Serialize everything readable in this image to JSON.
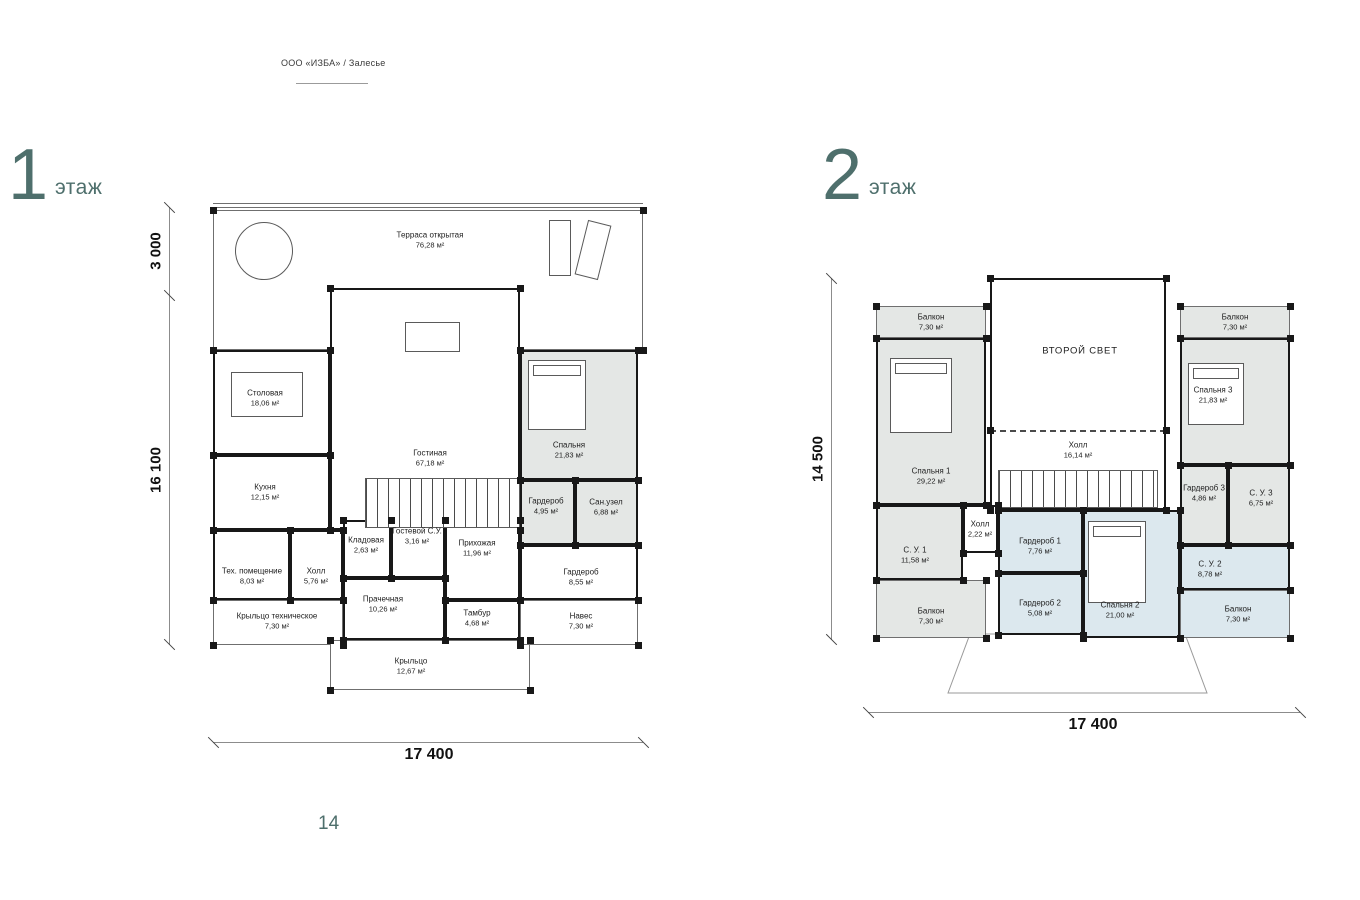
{
  "header": {
    "company": "ООО «ИЗБА» / Залесье"
  },
  "footer": {
    "page_number": "14"
  },
  "colors": {
    "accent": "#4e6f6c",
    "wall": "#181818",
    "room_gray": "#e4e7e5",
    "room_blue": "#dce8ee"
  },
  "floor1": {
    "number": "1",
    "word": "этаж",
    "dims": {
      "left_top": "3 000",
      "left_main": "16 100",
      "bottom": "17 400"
    },
    "rooms": [
      {
        "key": "terrasa",
        "name": "Терраса открытая",
        "area": "76,28 м²",
        "x": 0,
        "y": 10,
        "w": 430,
        "h": 140,
        "lx": 217,
        "ly": 40,
        "cls": "open"
      },
      {
        "key": "stolovaya",
        "name": "Столовая",
        "area": "18,06 м²",
        "x": 0,
        "y": 150,
        "w": 117,
        "h": 105,
        "lx": 52,
        "ly": 198,
        "cls": ""
      },
      {
        "key": "kuhnya",
        "name": "Кухня",
        "area": "12,15 м²",
        "x": 0,
        "y": 255,
        "w": 117,
        "h": 75,
        "lx": 52,
        "ly": 292,
        "cls": ""
      },
      {
        "key": "teh-pomeschenie",
        "name": "Тех. помещение",
        "area": "8,03 м²",
        "x": 0,
        "y": 330,
        "w": 77,
        "h": 70,
        "lx": 39,
        "ly": 376,
        "cls": ""
      },
      {
        "key": "holl",
        "name": "Холл",
        "area": "5,76 м²",
        "x": 77,
        "y": 330,
        "w": 53,
        "h": 70,
        "lx": 103,
        "ly": 376,
        "cls": ""
      },
      {
        "key": "kryltso-teh",
        "name": "Крыльцо техническое",
        "area": "7,30 м²",
        "x": 0,
        "y": 400,
        "w": 130,
        "h": 45,
        "lx": 64,
        "ly": 421,
        "cls": "open"
      },
      {
        "key": "gostinaya",
        "name": "Гостиная",
        "area": "67,18 м²",
        "x": 117,
        "y": 88,
        "w": 190,
        "h": 242,
        "lx": 217,
        "ly": 258,
        "cls": ""
      },
      {
        "key": "kladovaya",
        "name": "Кладовая",
        "area": "2,63 м²",
        "x": 130,
        "y": 320,
        "w": 48,
        "h": 58,
        "lx": 153,
        "ly": 345,
        "cls": ""
      },
      {
        "key": "gostevoy-su",
        "name": "Гостевой С.У.",
        "area": "3,16 м²",
        "x": 178,
        "y": 320,
        "w": 54,
        "h": 58,
        "lx": 204,
        "ly": 336,
        "cls": ""
      },
      {
        "key": "prihozhaya",
        "name": "Прихожая",
        "area": "11,96 м²",
        "x": 232,
        "y": 320,
        "w": 75,
        "h": 80,
        "lx": 264,
        "ly": 348,
        "cls": ""
      },
      {
        "key": "prachechnaya",
        "name": "Прачечная",
        "area": "10,26 м²",
        "x": 130,
        "y": 378,
        "w": 102,
        "h": 62,
        "lx": 170,
        "ly": 404,
        "cls": ""
      },
      {
        "key": "tambur",
        "name": "Тамбур",
        "area": "4,68 м²",
        "x": 232,
        "y": 400,
        "w": 75,
        "h": 40,
        "lx": 264,
        "ly": 418,
        "cls": ""
      },
      {
        "key": "kryltso",
        "name": "Крыльцо",
        "area": "12,67 м²",
        "x": 117,
        "y": 440,
        "w": 200,
        "h": 50,
        "lx": 198,
        "ly": 466,
        "cls": "open"
      },
      {
        "key": "spalnya",
        "name": "Спальня",
        "area": "21,83 м²",
        "x": 307,
        "y": 150,
        "w": 118,
        "h": 130,
        "lx": 356,
        "ly": 250,
        "cls": "gray"
      },
      {
        "key": "garderob-495",
        "name": "Гардероб",
        "area": "4,95 м²",
        "x": 307,
        "y": 280,
        "w": 55,
        "h": 65,
        "lx": 333,
        "ly": 306,
        "cls": "gray"
      },
      {
        "key": "sanuzel",
        "name": "Сан.узел",
        "area": "6,88 м²",
        "x": 362,
        "y": 280,
        "w": 63,
        "h": 65,
        "lx": 393,
        "ly": 307,
        "cls": "gray"
      },
      {
        "key": "garderob-855",
        "name": "Гардероб",
        "area": "8,55 м²",
        "x": 307,
        "y": 345,
        "w": 118,
        "h": 55,
        "lx": 368,
        "ly": 377,
        "cls": ""
      },
      {
        "key": "naves",
        "name": "Навес",
        "area": "7,30 м²",
        "x": 307,
        "y": 400,
        "w": 118,
        "h": 45,
        "lx": 368,
        "ly": 421,
        "cls": "open"
      }
    ],
    "features": [
      {
        "type": "circle",
        "x": 22,
        "y": 22,
        "w": 58,
        "h": 58
      },
      {
        "type": "rect",
        "x": 336,
        "y": 20,
        "w": 22,
        "h": 56
      },
      {
        "type": "rect",
        "x": 368,
        "y": 22,
        "w": 24,
        "h": 56,
        "rot": 14
      },
      {
        "type": "rect",
        "x": 18,
        "y": 172,
        "w": 72,
        "h": 45
      },
      {
        "type": "rect",
        "x": 192,
        "y": 122,
        "w": 55,
        "h": 30
      },
      {
        "type": "bed",
        "x": 315,
        "y": 160,
        "w": 58,
        "h": 70
      },
      {
        "type": "stairs",
        "x": 152,
        "y": 278,
        "w": 155,
        "h": 50
      }
    ]
  },
  "floor2": {
    "number": "2",
    "word": "этаж",
    "dims": {
      "left": "14 500",
      "bottom": "17 400"
    },
    "rooms": [
      {
        "key": "vtoroy-svet",
        "name": "ВТОРОЙ СВЕТ",
        "area": "",
        "x": 122,
        "y": 0,
        "w": 176,
        "h": 152,
        "lx": 212,
        "ly": 73,
        "cls": "no-bottom",
        "caps": true
      },
      {
        "key": "holl-16",
        "name": "Холл",
        "area": "16,14 м²",
        "x": 122,
        "y": 152,
        "w": 176,
        "h": 80,
        "lx": 210,
        "ly": 172,
        "cls": "dash-top"
      },
      {
        "key": "balkon-tl",
        "name": "Балкон",
        "area": "7,30 м²",
        "x": 8,
        "y": 28,
        "w": 110,
        "h": 32,
        "lx": 63,
        "ly": 44,
        "cls": "gray open"
      },
      {
        "key": "spalnya-1",
        "name": "Спальня 1",
        "area": "29,22 м²",
        "x": 8,
        "y": 60,
        "w": 110,
        "h": 167,
        "lx": 63,
        "ly": 198,
        "cls": "gray"
      },
      {
        "key": "su-1",
        "name": "С. У. 1",
        "area": "11,58 м²",
        "x": 8,
        "y": 227,
        "w": 87,
        "h": 75,
        "lx": 47,
        "ly": 277,
        "cls": "gray"
      },
      {
        "key": "holl-2",
        "name": "Холл",
        "area": "2,22 м²",
        "x": 95,
        "y": 227,
        "w": 35,
        "h": 48,
        "lx": 112,
        "ly": 251,
        "cls": ""
      },
      {
        "key": "garderob-1",
        "name": "Гардероб 1",
        "area": "7,76 м²",
        "x": 130,
        "y": 232,
        "w": 85,
        "h": 63,
        "lx": 172,
        "ly": 268,
        "cls": "blue"
      },
      {
        "key": "garderob-2",
        "name": "Гардероб 2",
        "area": "5,08 м²",
        "x": 130,
        "y": 295,
        "w": 85,
        "h": 62,
        "lx": 172,
        "ly": 330,
        "cls": "blue"
      },
      {
        "key": "balkon-bl",
        "name": "Балкон",
        "area": "7,30 м²",
        "x": 8,
        "y": 302,
        "w": 110,
        "h": 58,
        "lx": 63,
        "ly": 338,
        "cls": "gray open"
      },
      {
        "key": "spalnya-2",
        "name": "Спальня 2",
        "area": "21,00 м²",
        "x": 215,
        "y": 232,
        "w": 97,
        "h": 128,
        "lx": 252,
        "ly": 332,
        "cls": "blue"
      },
      {
        "key": "balkon-tr",
        "name": "Балкон",
        "area": "7,30 м²",
        "x": 312,
        "y": 28,
        "w": 110,
        "h": 32,
        "lx": 367,
        "ly": 44,
        "cls": "gray open"
      },
      {
        "key": "spalnya-3",
        "name": "Спальня 3",
        "area": "21,83 м²",
        "x": 312,
        "y": 60,
        "w": 110,
        "h": 127,
        "lx": 345,
        "ly": 117,
        "cls": "gray"
      },
      {
        "key": "garderob-3",
        "name": "Гардероб 3",
        "area": "4,86 м²",
        "x": 312,
        "y": 187,
        "w": 48,
        "h": 80,
        "lx": 336,
        "ly": 215,
        "cls": "gray"
      },
      {
        "key": "su-3",
        "name": "С. У. 3",
        "area": "6,75 м²",
        "x": 360,
        "y": 187,
        "w": 62,
        "h": 80,
        "lx": 393,
        "ly": 220,
        "cls": "gray"
      },
      {
        "key": "su-2",
        "name": "С. У. 2",
        "area": "8,78 м²",
        "x": 312,
        "y": 267,
        "w": 110,
        "h": 45,
        "lx": 342,
        "ly": 291,
        "cls": "blue"
      },
      {
        "key": "balkon-br",
        "name": "Балкон",
        "area": "7,30 м²",
        "x": 312,
        "y": 312,
        "w": 110,
        "h": 48,
        "lx": 370,
        "ly": 336,
        "cls": "blue open"
      }
    ],
    "features": [
      {
        "type": "bed",
        "x": 22,
        "y": 80,
        "w": 62,
        "h": 75
      },
      {
        "type": "bed",
        "x": 320,
        "y": 85,
        "w": 56,
        "h": 62
      },
      {
        "type": "bed",
        "x": 220,
        "y": 243,
        "w": 58,
        "h": 82
      },
      {
        "type": "stairs",
        "x": 130,
        "y": 192,
        "w": 160,
        "h": 38
      }
    ]
  }
}
